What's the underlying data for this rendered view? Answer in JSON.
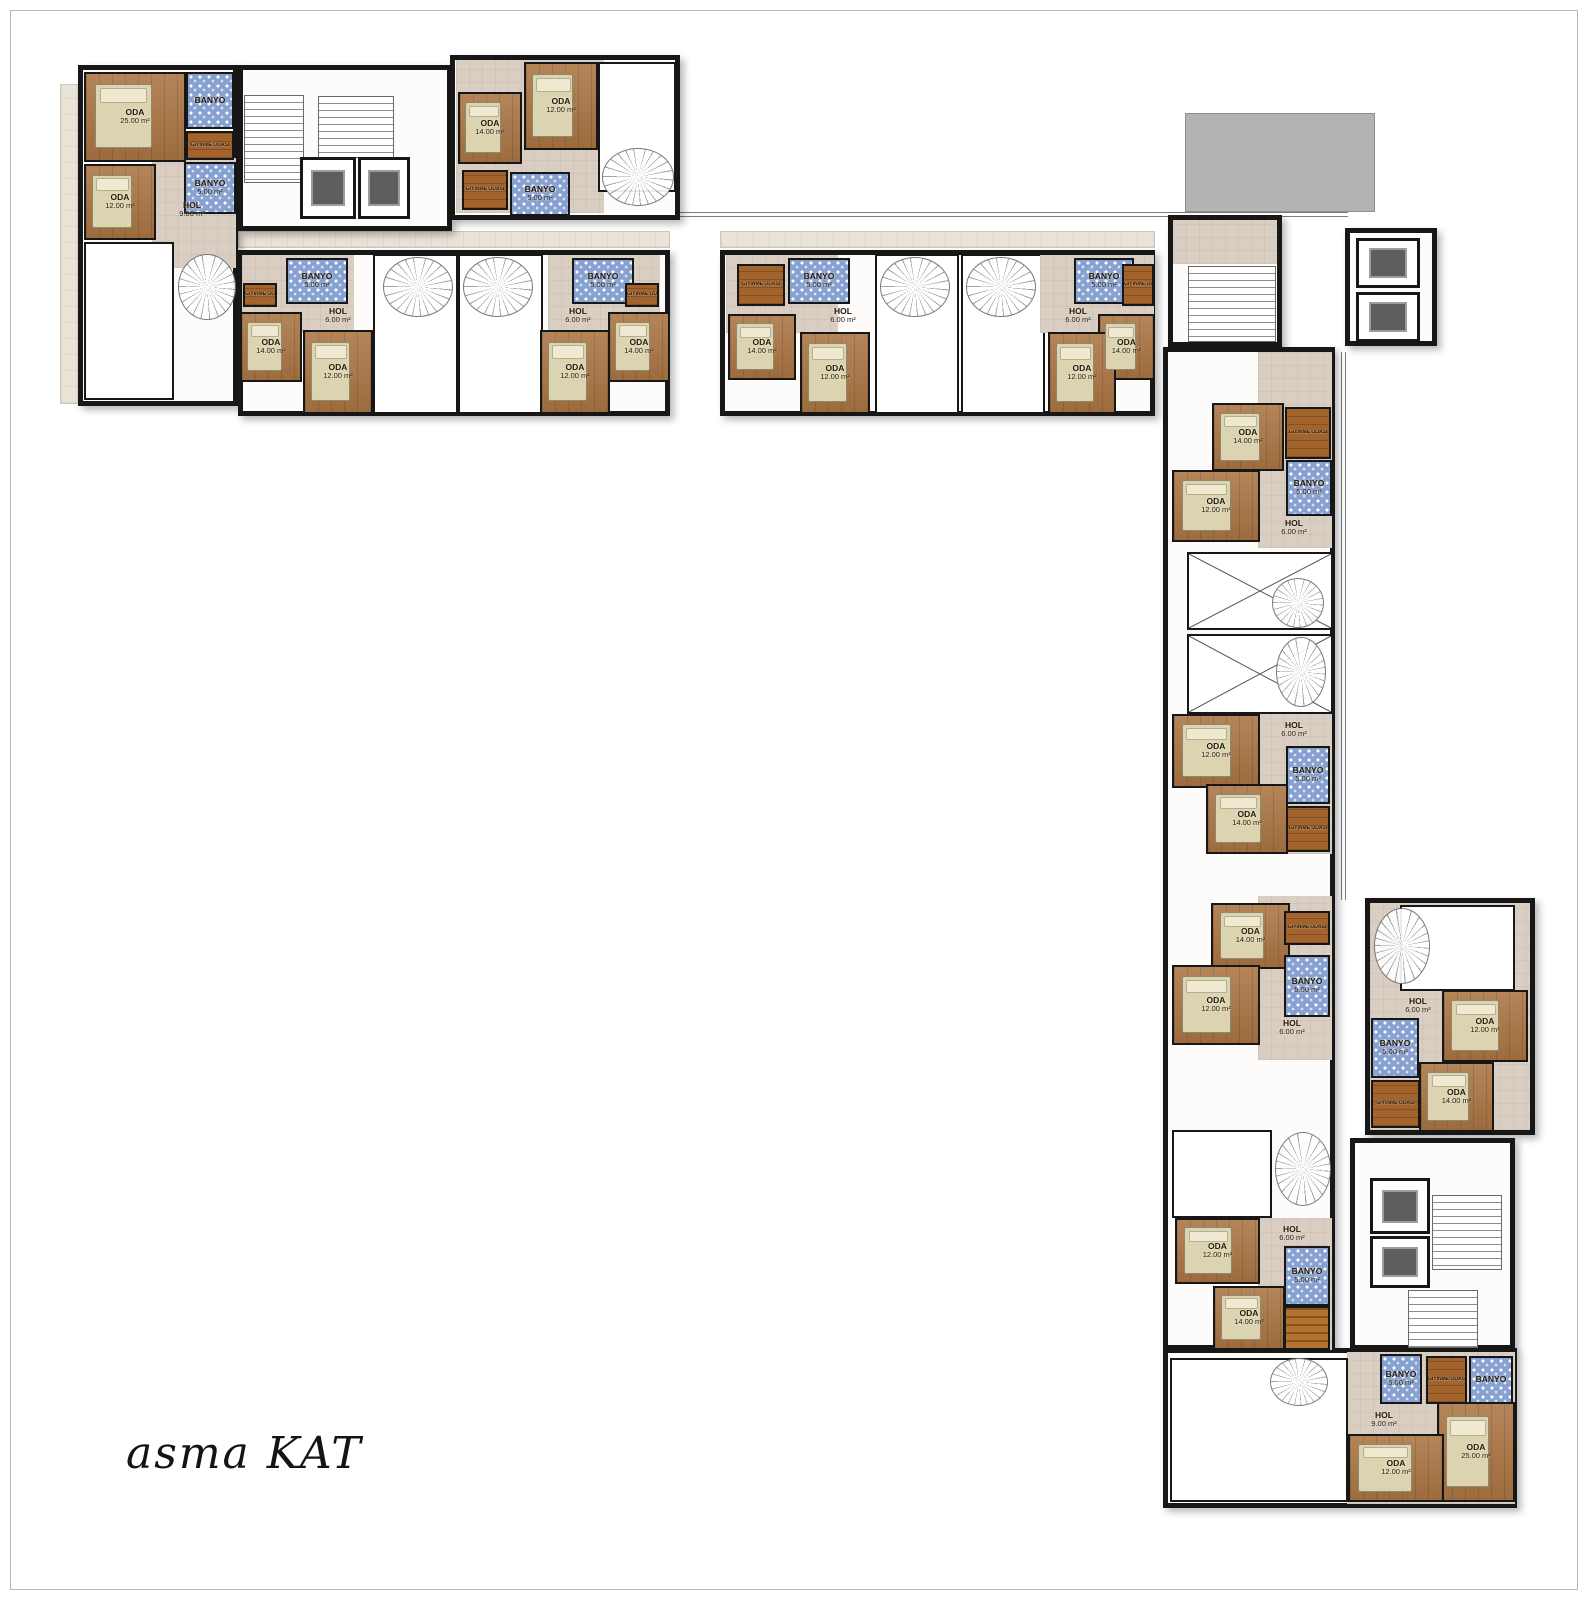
{
  "title": "asma KAT",
  "plan_name": "mezzanine floor plan",
  "room_labels": {
    "oda": "ODA",
    "banyo": "BANYO",
    "hol": "HOL",
    "giyinme": "GİYİNME ODASI"
  },
  "areas": {
    "oda_small": "12.00 m²",
    "oda_mid": "14.00 m²",
    "oda_large": "25.00 m²",
    "banyo": "5.00 m²",
    "hol_small": "6.00 m²",
    "hol_large": "9.00 m²"
  },
  "colors": {
    "wall": "#171717",
    "wood": "#aa7a4c",
    "dark_wood": "#a2632c",
    "tile_blue": "#87a1d0",
    "hall": "#d9cec1",
    "paving": "#e9e3d8",
    "terrace": "#b3b3b3",
    "elevator_car": "#5e5e5e",
    "bed": "#dcd4b0",
    "title_text": "#141414"
  },
  "elements": [
    {
      "n": "paving-left",
      "t": "paving",
      "r": [
        60,
        84,
        24,
        320
      ]
    },
    {
      "n": "paving-band-west",
      "t": "paving",
      "r": [
        238,
        231,
        432,
        17
      ]
    },
    {
      "n": "paving-band-east",
      "t": "paving",
      "r": [
        720,
        231,
        435,
        17
      ]
    },
    {
      "n": "terrace-roof",
      "t": "terrace",
      "r": [
        1185,
        113,
        190,
        99
      ]
    },
    {
      "n": "railing-top",
      "t": "railh",
      "r": [
        668,
        212,
        680,
        5
      ]
    },
    {
      "n": "railing-right",
      "t": "railv",
      "r": [
        1341,
        352,
        5,
        548
      ]
    },
    {
      "n": "unit-top-left",
      "t": "outline",
      "r": [
        78,
        65,
        160,
        341
      ]
    },
    {
      "n": "stair-core-top",
      "t": "outline",
      "r": [
        238,
        65,
        214,
        166
      ]
    },
    {
      "n": "unit-top-center",
      "t": "outline",
      "r": [
        450,
        55,
        230,
        165
      ]
    },
    {
      "n": "band-west-block",
      "t": "outline",
      "r": [
        238,
        250,
        432,
        166
      ]
    },
    {
      "n": "band-east-block",
      "t": "outline",
      "r": [
        720,
        250,
        435,
        166
      ]
    },
    {
      "n": "wing-stair-block",
      "t": "outline",
      "r": [
        1168,
        215,
        114,
        132
      ]
    },
    {
      "n": "elevator-pod-top",
      "t": "outline",
      "r": [
        1345,
        228,
        92,
        118
      ]
    },
    {
      "n": "wing-south-block",
      "t": "outline",
      "r": [
        1163,
        347,
        172,
        1003
      ]
    },
    {
      "n": "unit-detached-east",
      "t": "outline",
      "r": [
        1365,
        898,
        170,
        237
      ]
    },
    {
      "n": "core-bottom-block",
      "t": "outline",
      "r": [
        1350,
        1138,
        165,
        212
      ]
    },
    {
      "n": "unit-bottom",
      "t": "outline",
      "r": [
        1163,
        1348,
        354,
        160
      ]
    },
    {
      "t": "taupe",
      "r": [
        152,
        158,
        84,
        110
      ]
    },
    {
      "t": "wood",
      "r": [
        84,
        72,
        102,
        90
      ],
      "l1": "ODA",
      "l2": "25.00 m²",
      "b": 1
    },
    {
      "t": "tile",
      "r": [
        186,
        72,
        48,
        57
      ],
      "l1": "BANYO"
    },
    {
      "t": "woodd",
      "r": [
        186,
        131,
        48,
        29
      ],
      "l1": "GİYİNME ODASI",
      "s": 1
    },
    {
      "t": "tile",
      "r": [
        184,
        162,
        52,
        52
      ],
      "l1": "BANYO",
      "l2": "5.00 m²"
    },
    {
      "t": "wood",
      "r": [
        84,
        164,
        72,
        76
      ],
      "l1": "ODA",
      "l2": "12.00 m²",
      "b": 1
    },
    {
      "t": "label",
      "r": [
        160,
        198,
        64,
        24
      ],
      "l1": "HOL",
      "l2": "9.00 m²"
    },
    {
      "t": "white",
      "r": [
        84,
        242,
        90,
        158
      ]
    },
    {
      "t": "spiral",
      "r": [
        178,
        254,
        58,
        66
      ]
    },
    {
      "t": "stair",
      "r": [
        244,
        95,
        60,
        88
      ]
    },
    {
      "t": "stair",
      "r": [
        318,
        96,
        76,
        62
      ]
    },
    {
      "t": "elev",
      "r": [
        300,
        157,
        56,
        62
      ]
    },
    {
      "t": "elev",
      "r": [
        358,
        157,
        52,
        62
      ]
    },
    {
      "t": "taupe",
      "r": [
        456,
        60,
        148,
        153
      ]
    },
    {
      "t": "wood",
      "r": [
        524,
        62,
        74,
        88
      ],
      "l1": "ODA",
      "l2": "12.00 m²",
      "b": 1
    },
    {
      "t": "wood",
      "r": [
        458,
        92,
        64,
        72
      ],
      "l1": "ODA",
      "l2": "14.00 m²",
      "b": 1
    },
    {
      "t": "woodd",
      "r": [
        462,
        170,
        46,
        40
      ],
      "l1": "GİYİNME ODASI",
      "s": 1
    },
    {
      "t": "tile",
      "r": [
        510,
        172,
        60,
        44
      ],
      "l1": "BANYO",
      "l2": "5.00 m²"
    },
    {
      "t": "white",
      "r": [
        598,
        62,
        78,
        130
      ]
    },
    {
      "t": "spiral",
      "r": [
        602,
        148,
        72,
        58
      ]
    },
    {
      "t": "taupe",
      "r": [
        242,
        255,
        112,
        78
      ]
    },
    {
      "t": "woodd",
      "r": [
        243,
        283,
        34,
        24
      ],
      "l1": "GİYİNME ODASI",
      "s": 1
    },
    {
      "t": "tile",
      "r": [
        286,
        258,
        62,
        46
      ],
      "l1": "BANYO",
      "l2": "5.00 m²"
    },
    {
      "t": "label",
      "r": [
        308,
        304,
        60,
        24
      ],
      "l1": "HOL",
      "l2": "6.00 m²"
    },
    {
      "t": "wood",
      "r": [
        240,
        312,
        62,
        70
      ],
      "l1": "ODA",
      "l2": "14.00 m²",
      "b": 1
    },
    {
      "t": "wood",
      "r": [
        303,
        330,
        70,
        84
      ],
      "l1": "ODA",
      "l2": "12.00 m²",
      "b": 1
    },
    {
      "t": "white",
      "r": [
        373,
        254,
        85,
        160
      ]
    },
    {
      "t": "spiral",
      "r": [
        383,
        257,
        70,
        60
      ]
    },
    {
      "t": "white",
      "r": [
        458,
        254,
        85,
        160
      ]
    },
    {
      "t": "spiral",
      "r": [
        463,
        257,
        70,
        60
      ]
    },
    {
      "t": "taupe",
      "r": [
        548,
        255,
        112,
        78
      ]
    },
    {
      "t": "tile",
      "r": [
        572,
        258,
        62,
        46
      ],
      "l1": "BANYO",
      "l2": "5.00 m²"
    },
    {
      "t": "woodd",
      "r": [
        625,
        283,
        34,
        24
      ],
      "l1": "GİYİNME ODASI",
      "s": 1
    },
    {
      "t": "label",
      "r": [
        548,
        304,
        60,
        24
      ],
      "l1": "HOL",
      "l2": "6.00 m²"
    },
    {
      "t": "wood",
      "r": [
        608,
        312,
        62,
        70
      ],
      "l1": "ODA",
      "l2": "14.00 m²",
      "b": 1
    },
    {
      "t": "wood",
      "r": [
        540,
        330,
        70,
        84
      ],
      "l1": "ODA",
      "l2": "12.00 m²",
      "b": 1
    },
    {
      "t": "taupe",
      "r": [
        726,
        255,
        112,
        78
      ]
    },
    {
      "t": "woodd",
      "r": [
        737,
        264,
        48,
        42
      ],
      "l1": "GİYİNME ODASI",
      "s": 1
    },
    {
      "t": "tile",
      "r": [
        788,
        258,
        62,
        46
      ],
      "l1": "BANYO",
      "l2": "5.00 m²"
    },
    {
      "t": "label",
      "r": [
        813,
        304,
        60,
        24
      ],
      "l1": "HOL",
      "l2": "6.00 m²"
    },
    {
      "t": "wood",
      "r": [
        728,
        314,
        68,
        66
      ],
      "l1": "ODA",
      "l2": "14.00 m²",
      "b": 1
    },
    {
      "t": "wood",
      "r": [
        800,
        332,
        70,
        82
      ],
      "l1": "ODA",
      "l2": "12.00 m²",
      "b": 1
    },
    {
      "t": "white",
      "r": [
        875,
        254,
        84,
        160
      ]
    },
    {
      "t": "spiral",
      "r": [
        880,
        257,
        70,
        60
      ]
    },
    {
      "t": "white",
      "r": [
        961,
        254,
        84,
        160
      ]
    },
    {
      "t": "spiral",
      "r": [
        966,
        257,
        70,
        60
      ]
    },
    {
      "t": "taupe",
      "r": [
        1040,
        255,
        114,
        78
      ]
    },
    {
      "t": "tile",
      "r": [
        1074,
        258,
        60,
        46
      ],
      "l1": "BANYO",
      "l2": "5.00 m²"
    },
    {
      "t": "woodd",
      "r": [
        1122,
        264,
        32,
        42
      ],
      "l1": "GİYİNME ODASI",
      "s": 1
    },
    {
      "t": "label",
      "r": [
        1048,
        304,
        60,
        24
      ],
      "l1": "HOL",
      "l2": "6.00 m²"
    },
    {
      "t": "wood",
      "r": [
        1098,
        314,
        57,
        66
      ],
      "l1": "ODA",
      "l2": "14.00 m²",
      "b": 1
    },
    {
      "t": "wood",
      "r": [
        1048,
        332,
        68,
        82
      ],
      "l1": "ODA",
      "l2": "12.00 m²",
      "b": 1
    },
    {
      "t": "taupe",
      "r": [
        1173,
        220,
        104,
        44
      ]
    },
    {
      "t": "stair",
      "r": [
        1188,
        266,
        88,
        76
      ]
    },
    {
      "t": "elev",
      "r": [
        1356,
        238,
        64,
        50
      ]
    },
    {
      "t": "elev",
      "r": [
        1356,
        292,
        64,
        50
      ]
    },
    {
      "t": "taupe",
      "r": [
        1258,
        352,
        74,
        196
      ]
    },
    {
      "t": "wood",
      "r": [
        1212,
        403,
        72,
        68
      ],
      "l1": "ODA",
      "l2": "14.00 m²",
      "b": 1
    },
    {
      "t": "woodd",
      "r": [
        1285,
        407,
        46,
        52
      ],
      "l1": "GİYİNME ODASI",
      "s": 1
    },
    {
      "t": "tile",
      "r": [
        1286,
        460,
        46,
        56
      ],
      "l1": "BANYO",
      "l2": "5.00 m²"
    },
    {
      "t": "wood",
      "r": [
        1172,
        470,
        88,
        72
      ],
      "l1": "ODA",
      "l2": "12.00 m²",
      "b": 1
    },
    {
      "t": "label",
      "r": [
        1264,
        516,
        60,
        24
      ],
      "l1": "HOL",
      "l2": "6.00 m²"
    },
    {
      "t": "void",
      "r": [
        1187,
        552,
        146,
        78
      ]
    },
    {
      "t": "spiral",
      "r": [
        1272,
        578,
        52,
        50
      ]
    },
    {
      "t": "void",
      "r": [
        1187,
        634,
        146,
        80
      ]
    },
    {
      "t": "spiral",
      "r": [
        1276,
        637,
        50,
        70
      ]
    },
    {
      "t": "taupe",
      "r": [
        1258,
        714,
        74,
        140
      ]
    },
    {
      "t": "label",
      "r": [
        1264,
        718,
        60,
        24
      ],
      "l1": "HOL",
      "l2": "6.00 m²"
    },
    {
      "t": "wood",
      "r": [
        1172,
        714,
        88,
        74
      ],
      "l1": "ODA",
      "l2": "12.00 m²",
      "b": 1
    },
    {
      "t": "tile",
      "r": [
        1286,
        746,
        44,
        58
      ],
      "l1": "BANYO",
      "l2": "5.00 m²"
    },
    {
      "t": "wood",
      "r": [
        1206,
        784,
        82,
        70
      ],
      "l1": "ODA",
      "l2": "14.00 m²",
      "b": 1
    },
    {
      "t": "woodd",
      "r": [
        1286,
        806,
        44,
        46
      ],
      "l1": "GİYİNME ODASI",
      "s": 1
    },
    {
      "t": "taupe",
      "r": [
        1258,
        896,
        74,
        164
      ]
    },
    {
      "t": "wood",
      "r": [
        1211,
        903,
        79,
        66
      ],
      "l1": "ODA",
      "l2": "14.00 m²",
      "b": 1
    },
    {
      "t": "woodd",
      "r": [
        1284,
        911,
        46,
        34
      ],
      "l1": "GİYİNME ODASI",
      "s": 1
    },
    {
      "t": "tile",
      "r": [
        1284,
        955,
        46,
        62
      ],
      "l1": "BANYO",
      "l2": "5.00 m²"
    },
    {
      "t": "wood",
      "r": [
        1172,
        965,
        88,
        80
      ],
      "l1": "ODA",
      "l2": "12.00 m²",
      "b": 1
    },
    {
      "t": "label",
      "r": [
        1262,
        1016,
        60,
        24
      ],
      "l1": "HOL",
      "l2": "6.00 m²"
    },
    {
      "t": "white",
      "r": [
        1172,
        1130,
        100,
        88
      ]
    },
    {
      "t": "spiral",
      "r": [
        1275,
        1132,
        56,
        74
      ]
    },
    {
      "t": "taupe",
      "r": [
        1258,
        1218,
        74,
        132
      ]
    },
    {
      "t": "label",
      "r": [
        1262,
        1222,
        60,
        24
      ],
      "l1": "HOL",
      "l2": "6.00 m²"
    },
    {
      "t": "wood",
      "r": [
        1175,
        1218,
        85,
        66
      ],
      "l1": "ODA",
      "l2": "12.00 m²",
      "b": 1
    },
    {
      "t": "tile",
      "r": [
        1284,
        1246,
        46,
        60
      ],
      "l1": "BANYO",
      "l2": "5.00 m²"
    },
    {
      "t": "wood",
      "r": [
        1213,
        1286,
        72,
        64
      ],
      "l1": "ODA",
      "l2": "14.00 m²",
      "b": 1
    },
    {
      "t": "stairo",
      "r": [
        1284,
        1306,
        46,
        44
      ]
    },
    {
      "t": "taupe",
      "r": [
        1370,
        903,
        160,
        227
      ]
    },
    {
      "t": "white",
      "r": [
        1400,
        905,
        115,
        86
      ]
    },
    {
      "t": "spiral",
      "r": [
        1374,
        908,
        56,
        76
      ]
    },
    {
      "t": "label",
      "r": [
        1388,
        994,
        60,
        24
      ],
      "l1": "HOL",
      "l2": "6.00 m²"
    },
    {
      "t": "tile",
      "r": [
        1371,
        1018,
        48,
        60
      ],
      "l1": "BANYO",
      "l2": "5.00 m²"
    },
    {
      "t": "wood",
      "r": [
        1442,
        990,
        86,
        72
      ],
      "l1": "ODA",
      "l2": "12.00 m²",
      "b": 1
    },
    {
      "t": "wood",
      "r": [
        1419,
        1062,
        75,
        70
      ],
      "l1": "ODA",
      "l2": "14.00 m²",
      "b": 1
    },
    {
      "t": "woodd",
      "r": [
        1371,
        1080,
        49,
        48
      ],
      "l1": "GİYİNME ODASI",
      "s": 1
    },
    {
      "t": "elev",
      "r": [
        1370,
        1178,
        60,
        56
      ]
    },
    {
      "t": "elev",
      "r": [
        1370,
        1236,
        60,
        52
      ]
    },
    {
      "t": "stair",
      "r": [
        1432,
        1195,
        70,
        75
      ]
    },
    {
      "t": "stair",
      "r": [
        1408,
        1290,
        70,
        58
      ]
    },
    {
      "t": "taupe",
      "r": [
        1347,
        1352,
        168,
        152
      ]
    },
    {
      "t": "white",
      "r": [
        1170,
        1358,
        178,
        144
      ]
    },
    {
      "t": "spiral",
      "r": [
        1270,
        1358,
        58,
        48
      ]
    },
    {
      "t": "tile",
      "r": [
        1380,
        1354,
        42,
        50
      ],
      "l1": "BANYO",
      "l2": "5.00 m²"
    },
    {
      "t": "woodd",
      "r": [
        1426,
        1356,
        41,
        48
      ],
      "l1": "GİYİNME ODASI",
      "s": 1
    },
    {
      "t": "tile",
      "r": [
        1469,
        1356,
        44,
        48
      ],
      "l1": "BANYO"
    },
    {
      "t": "label",
      "r": [
        1352,
        1408,
        64,
        24
      ],
      "l1": "HOL",
      "l2": "9.00 m²"
    },
    {
      "t": "wood",
      "r": [
        1437,
        1402,
        78,
        100
      ],
      "l1": "ODA",
      "l2": "25.00 m²",
      "b": 1
    },
    {
      "t": "wood",
      "r": [
        1348,
        1434,
        96,
        68
      ],
      "l1": "ODA",
      "l2": "12.00 m²",
      "b": 1
    }
  ]
}
